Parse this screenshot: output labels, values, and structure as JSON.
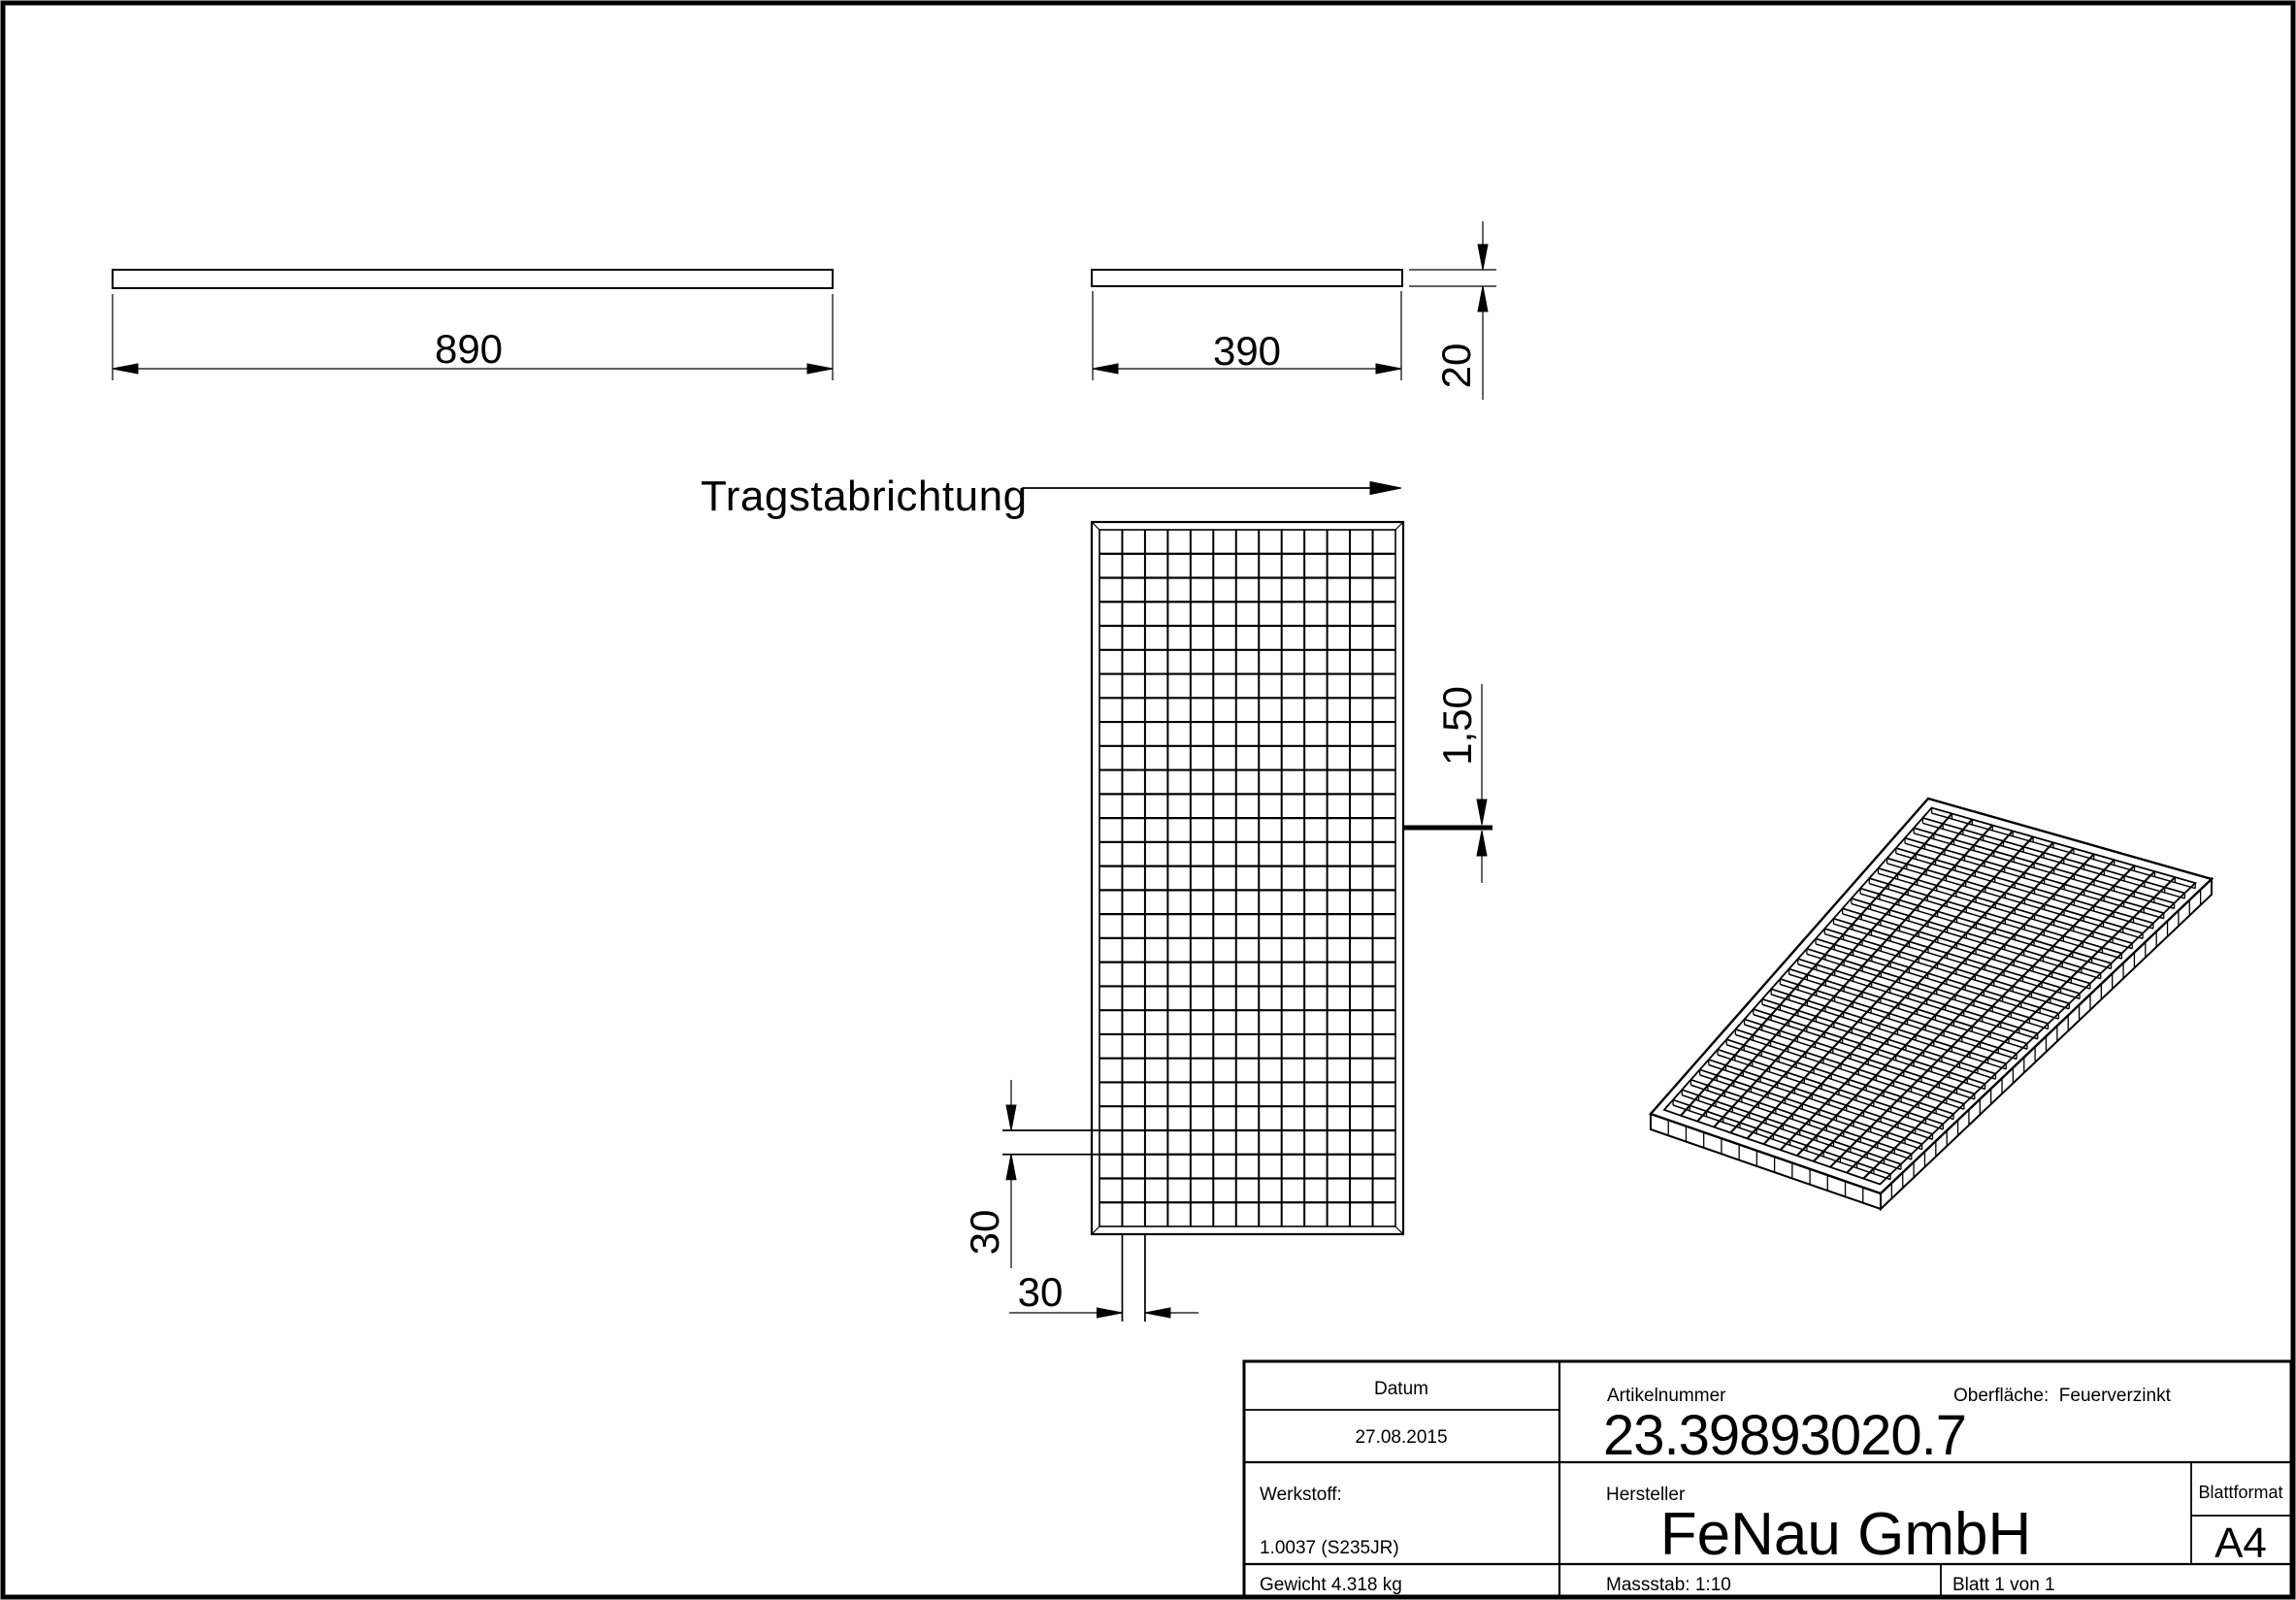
{
  "sheet": {
    "background": "#ffffff",
    "line_color": "#000000"
  },
  "views": {
    "top_bar_long": {
      "width_label": "890"
    },
    "top_bar_short": {
      "width_label": "390",
      "thickness_label": "20"
    },
    "front": {
      "direction_label": "Tragstabrichtung",
      "bar_thickness_label": "1,50",
      "mesh_spacing_vertical_label": "30",
      "mesh_spacing_horizontal_label": "30",
      "grid_cols": 13,
      "grid_rows": 29
    },
    "iso": {
      "grid_cols": 13,
      "grid_rows": 30
    }
  },
  "title_block": {
    "datum_label": "Datum",
    "datum_value": "27.08.2015",
    "artikelnummer_label": "Artikelnummer",
    "artikelnummer_value": "23.39893020.7",
    "oberflaeche_label": "Oberfläche:  Feuerverzinkt",
    "werkstoff_label": "Werkstoff:",
    "werkstoff_value": "1.0037 (S235JR)",
    "hersteller_label": "Hersteller",
    "hersteller_value": "FeNau GmbH",
    "blattformat_label": "Blattformat",
    "blattformat_value": "A4",
    "gewicht_value": "Gewicht 4.318 kg",
    "massstab_value": "Massstab: 1:10",
    "blatt_value": "Blatt 1 von 1"
  }
}
